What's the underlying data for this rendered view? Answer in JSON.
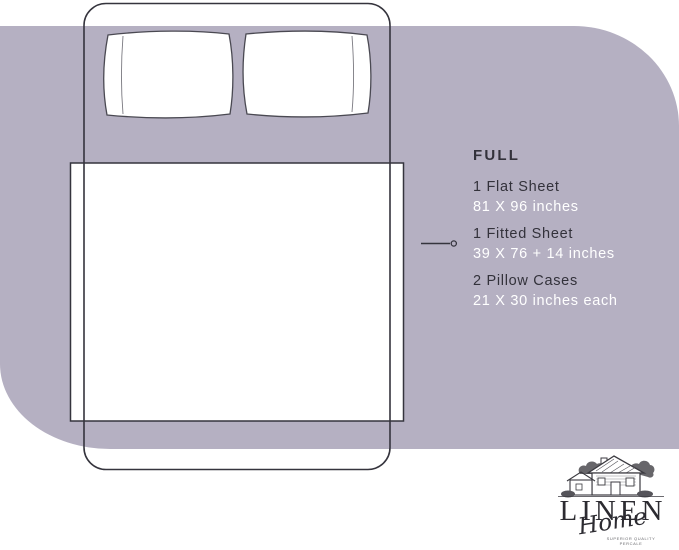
{
  "size_info": {
    "size_label": "FULL",
    "items": [
      {
        "name": "1 Flat Sheet",
        "dimensions": "81 X 96 inches"
      },
      {
        "name": "1 Fitted Sheet",
        "dimensions": "39 X 76 + 14 inches"
      },
      {
        "name": "2 Pillow Cases",
        "dimensions": "21 X 30 inches each"
      }
    ]
  },
  "logo": {
    "brand": "LINEN",
    "sub_brand": "Home",
    "tagline_line1": "SUPERIOR QUALITY",
    "tagline_line2": "PERCALE"
  },
  "colors": {
    "background": "#ffffff",
    "blob": "#b5b0c2",
    "outline": "#35343d",
    "dark_text": "#33323b",
    "light_text": "#ffffff"
  }
}
